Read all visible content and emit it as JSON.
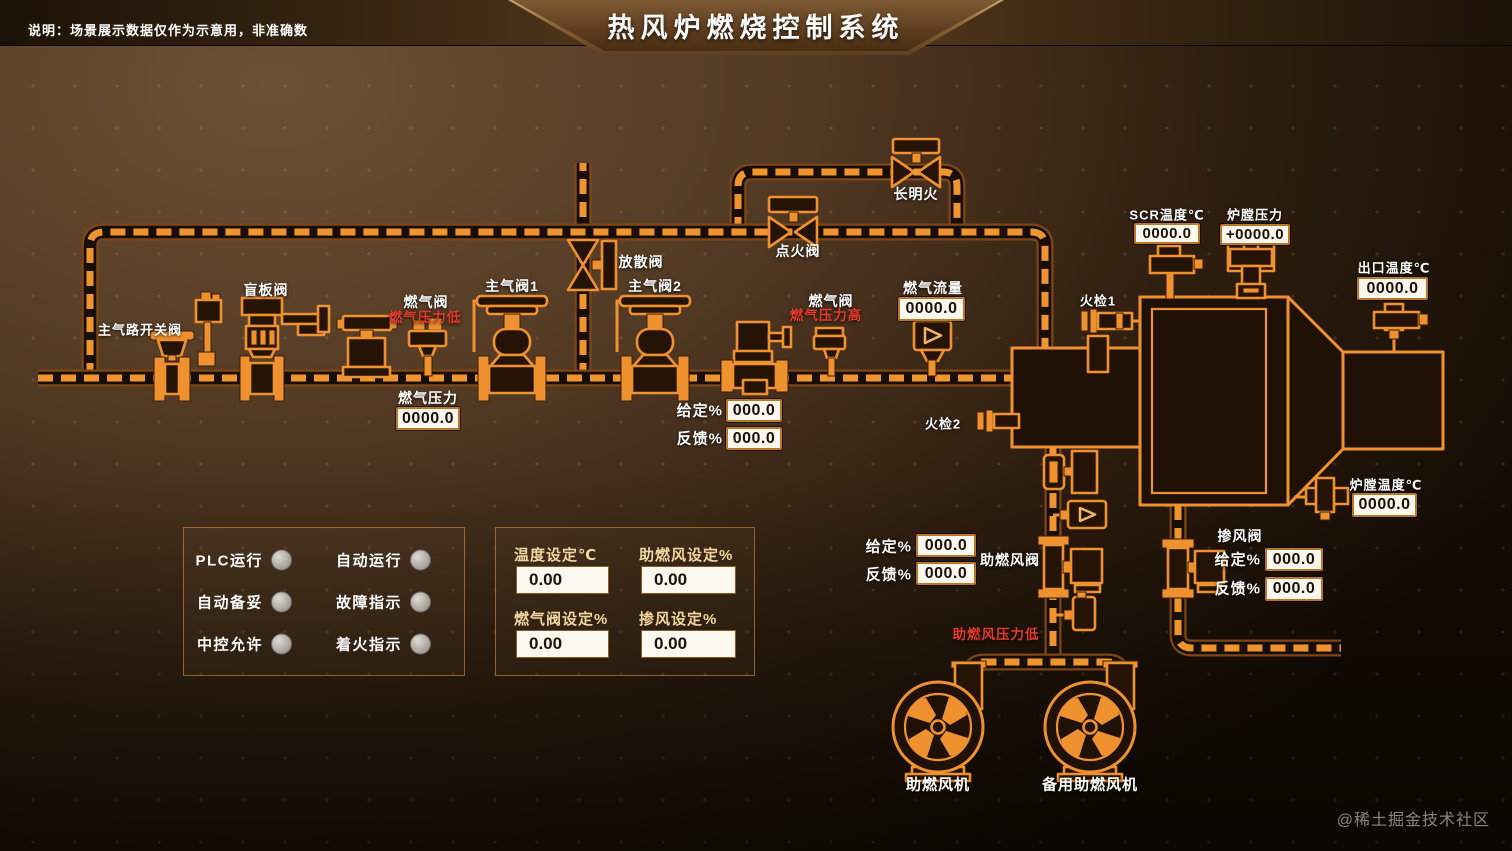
{
  "header": {
    "disclaimer": "说明：场景展示数据仅作为示意用，非准确数",
    "title": "热风炉燃烧控制系统"
  },
  "colors": {
    "pipe_orange": "#f09130",
    "alarm_red": "#e8392b",
    "readout_bg": "#fcf8f0",
    "panel_label_tan": "#f0d6a0"
  },
  "diagram": {
    "equipment_labels": {
      "main_switch_valve": "主气路开关阀",
      "blind_valve": "盲板阀",
      "gas_valve_left": "燃气阀",
      "main_valve_1": "主气阀1",
      "vent_valve": "放散阀",
      "main_valve_2": "主气阀2",
      "ignition_valve": "点火阀",
      "pilot_flame": "长明火",
      "gas_valve_right": "燃气阀",
      "flame_detector_1": "火检1",
      "flame_detector_2": "火检2",
      "aux_fan_valve": "助燃风阀",
      "mix_air_valve": "掺风阀",
      "aux_fan": "助燃风机",
      "backup_aux_fan": "备用助燃风机"
    },
    "alarms": {
      "gas_pressure_low": "燃气压力低",
      "gas_pressure_high": "燃气压力高",
      "aux_air_pressure_low": "助燃风压力低"
    },
    "readouts": {
      "gas_pressure": {
        "label": "燃气压力",
        "value": "0000.0"
      },
      "gas_flow": {
        "label": "燃气流量",
        "value": "0000.0"
      },
      "scr_temp": {
        "label": "SCR温度℃",
        "value": "0000.0"
      },
      "furnace_pressure": {
        "label": "炉膛压力",
        "value": "+0000.0"
      },
      "outlet_temp": {
        "label": "出口温度℃",
        "value": "0000.0"
      },
      "furnace_temp": {
        "label": "炉膛温度℃",
        "value": "0000.0"
      }
    },
    "valve_io": {
      "given_label": "给定%",
      "feedback_label": "反馈%",
      "main_gas": {
        "given": "000.0",
        "feedback": "000.0"
      },
      "aux_fan": {
        "given": "000.0",
        "feedback": "000.0"
      },
      "mix_air": {
        "given": "000.0",
        "feedback": "000.0"
      }
    }
  },
  "status_panel": {
    "items": [
      {
        "label": "PLC运行"
      },
      {
        "label": "自动运行"
      },
      {
        "label": "自动备妥"
      },
      {
        "label": "故障指示"
      },
      {
        "label": "中控允许"
      },
      {
        "label": "着火指示"
      }
    ]
  },
  "settings_panel": {
    "fields": [
      {
        "label": "温度设定℃",
        "value": "0.00"
      },
      {
        "label": "助燃风设定%",
        "value": "0.00"
      },
      {
        "label": "燃气阀设定%",
        "value": "0.00"
      },
      {
        "label": "掺风设定%",
        "value": "0.00"
      }
    ]
  },
  "watermark": "@稀土掘金技术社区"
}
